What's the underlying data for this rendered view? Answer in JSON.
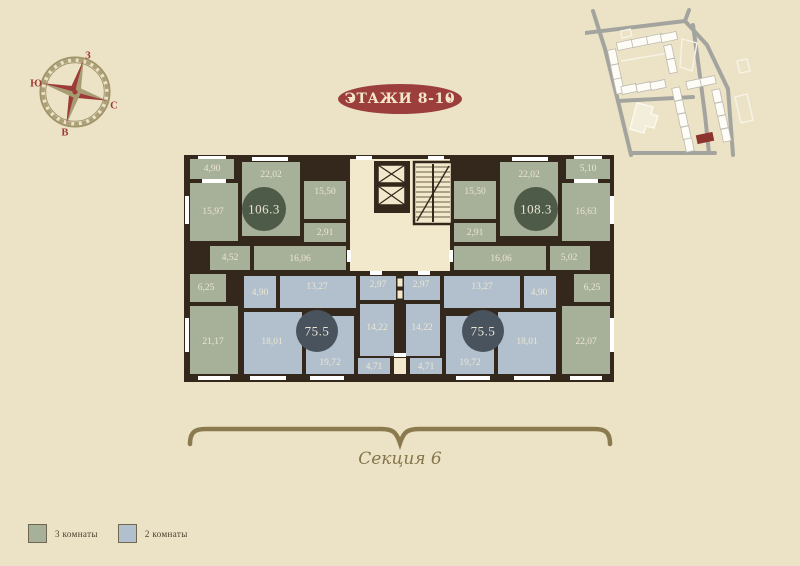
{
  "page": {
    "background": "#ece3c7"
  },
  "header": {
    "floors_badge": "ЭТАЖИ 8-10",
    "badge_color": "#9c3e3c"
  },
  "compass": {
    "top": "З",
    "left": "Ю",
    "right": "С",
    "bottom": "В"
  },
  "section": {
    "label": "Секция 6"
  },
  "legend": {
    "items": [
      {
        "label": "3 комнаты",
        "color": "#a7b098"
      },
      {
        "label": "2 комнаты",
        "color": "#b2c0cd"
      }
    ]
  },
  "floorplan": {
    "colors": {
      "wall": "#33281b",
      "room3k": "#a7b098",
      "room2k": "#b2c0cd",
      "corridor": "#f2e9cd",
      "badge3k": "#4e5b48",
      "badge2k": "#49535d",
      "label": "#ece6d2"
    },
    "apartments": [
      {
        "id": "apt-106",
        "total_area": "106.3",
        "type": "3k",
        "cx": 264,
        "cy": 209,
        "r": 22
      },
      {
        "id": "apt-108",
        "total_area": "108.3",
        "type": "3k",
        "cx": 536,
        "cy": 209,
        "r": 22
      },
      {
        "id": "apt-75-left",
        "total_area": "75.5",
        "type": "2k",
        "cx": 317,
        "cy": 331,
        "r": 21
      },
      {
        "id": "apt-75-right",
        "total_area": "75.5",
        "type": "2k",
        "cx": 483,
        "cy": 331,
        "r": 21
      }
    ],
    "rooms": [
      {
        "label": "4,90",
        "type": "3k",
        "x": 190,
        "y": 159,
        "w": 44,
        "h": 20,
        "lx": 212,
        "ly": 169
      },
      {
        "label": "15,97",
        "type": "3k",
        "x": 190,
        "y": 183,
        "w": 48,
        "h": 58,
        "lx": 213,
        "ly": 212
      },
      {
        "label": "22,02",
        "type": "3k",
        "x": 242,
        "y": 162,
        "w": 58,
        "h": 74,
        "lx": 271,
        "ly": 175
      },
      {
        "label": "15,50",
        "type": "3k",
        "x": 304,
        "y": 181,
        "w": 42,
        "h": 38,
        "lx": 325,
        "ly": 192
      },
      {
        "label": "2,91",
        "type": "3k",
        "x": 304,
        "y": 223,
        "w": 42,
        "h": 19,
        "lx": 325,
        "ly": 233
      },
      {
        "label": "4,52",
        "type": "3k",
        "x": 210,
        "y": 246,
        "w": 40,
        "h": 24,
        "lx": 230,
        "ly": 258
      },
      {
        "label": "16,06",
        "type": "3k",
        "x": 254,
        "y": 246,
        "w": 92,
        "h": 24,
        "lx": 300,
        "ly": 259
      },
      {
        "label": "6,25",
        "type": "3k",
        "x": 190,
        "y": 274,
        "w": 36,
        "h": 28,
        "lx": 206,
        "ly": 288
      },
      {
        "label": "21,17",
        "type": "3k",
        "x": 190,
        "y": 306,
        "w": 48,
        "h": 68,
        "lx": 213,
        "ly": 342
      },
      {
        "label": "5,10",
        "type": "3k",
        "x": 566,
        "y": 159,
        "w": 44,
        "h": 20,
        "lx": 588,
        "ly": 169
      },
      {
        "label": "16,63",
        "type": "3k",
        "x": 562,
        "y": 183,
        "w": 48,
        "h": 58,
        "lx": 586,
        "ly": 212
      },
      {
        "label": "22,02",
        "type": "3k",
        "x": 500,
        "y": 162,
        "w": 58,
        "h": 74,
        "lx": 529,
        "ly": 175
      },
      {
        "label": "15,50",
        "type": "3k",
        "x": 454,
        "y": 181,
        "w": 42,
        "h": 38,
        "lx": 475,
        "ly": 192
      },
      {
        "label": "2,91",
        "type": "3k",
        "x": 454,
        "y": 223,
        "w": 42,
        "h": 19,
        "lx": 475,
        "ly": 233
      },
      {
        "label": "5,02",
        "type": "3k",
        "x": 550,
        "y": 246,
        "w": 40,
        "h": 24,
        "lx": 569,
        "ly": 258
      },
      {
        "label": "16,06",
        "type": "3k",
        "x": 454,
        "y": 246,
        "w": 92,
        "h": 24,
        "lx": 501,
        "ly": 259
      },
      {
        "label": "6,25",
        "type": "3k",
        "x": 574,
        "y": 274,
        "w": 36,
        "h": 28,
        "lx": 592,
        "ly": 288
      },
      {
        "label": "22,07",
        "type": "3k",
        "x": 562,
        "y": 306,
        "w": 48,
        "h": 68,
        "lx": 586,
        "ly": 342
      },
      {
        "label": "4,90",
        "type": "2k",
        "x": 244,
        "y": 276,
        "w": 32,
        "h": 32,
        "lx": 260,
        "ly": 293
      },
      {
        "label": "13,27",
        "type": "2k",
        "x": 280,
        "y": 276,
        "w": 76,
        "h": 32,
        "lx": 317,
        "ly": 287
      },
      {
        "label": "2,97",
        "type": "2k",
        "x": 360,
        "y": 276,
        "w": 36,
        "h": 24,
        "lx": 378,
        "ly": 285
      },
      {
        "label": "18,01",
        "type": "2k",
        "x": 244,
        "y": 312,
        "w": 58,
        "h": 62,
        "lx": 272,
        "ly": 342
      },
      {
        "label": "14,22",
        "type": "2k",
        "x": 360,
        "y": 304,
        "w": 34,
        "h": 52,
        "lx": 377,
        "ly": 328
      },
      {
        "label": "19,72",
        "type": "2k",
        "x": 306,
        "y": 316,
        "w": 48,
        "h": 58,
        "lx": 330,
        "ly": 363
      },
      {
        "label": "4,71",
        "type": "2k",
        "x": 358,
        "y": 358,
        "w": 32,
        "h": 16,
        "lx": 374,
        "ly": 367
      },
      {
        "label": "2,97",
        "type": "2k",
        "x": 404,
        "y": 276,
        "w": 36,
        "h": 24,
        "lx": 421,
        "ly": 285
      },
      {
        "label": "13,27",
        "type": "2k",
        "x": 444,
        "y": 276,
        "w": 76,
        "h": 32,
        "lx": 482,
        "ly": 287
      },
      {
        "label": "4,90",
        "type": "2k",
        "x": 524,
        "y": 276,
        "w": 32,
        "h": 32,
        "lx": 539,
        "ly": 293
      },
      {
        "label": "14,22",
        "type": "2k",
        "x": 406,
        "y": 304,
        "w": 34,
        "h": 52,
        "lx": 422,
        "ly": 328
      },
      {
        "label": "19,72",
        "type": "2k",
        "x": 446,
        "y": 316,
        "w": 48,
        "h": 58,
        "lx": 470,
        "ly": 363
      },
      {
        "label": "18,01",
        "type": "2k",
        "x": 498,
        "y": 312,
        "w": 58,
        "h": 62,
        "lx": 527,
        "ly": 342
      },
      {
        "label": "4,71",
        "type": "2k",
        "x": 410,
        "y": 358,
        "w": 32,
        "h": 16,
        "lx": 426,
        "ly": 367
      }
    ]
  }
}
